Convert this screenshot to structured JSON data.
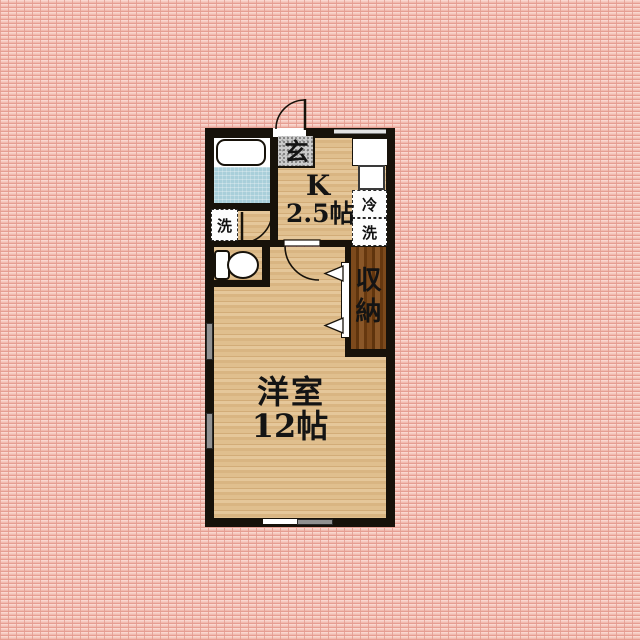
{
  "floorplan": {
    "entrance": {
      "label": "玄"
    },
    "kitchen": {
      "name": "K",
      "size": "2.5帖"
    },
    "main_room": {
      "name": "洋室",
      "size": "12帖"
    },
    "closet": {
      "chars": [
        "収",
        "納"
      ]
    },
    "equipment": {
      "washer_left": "洗",
      "fridge": "冷",
      "washer_right": "洗"
    },
    "colors": {
      "wall": "#17120a",
      "wood_floor": "#dfbe8d",
      "closet_wood": "#6e3e13",
      "bath_floor_blue": "#a9cfda",
      "entrance_tile_gray": "#cccccc",
      "background_pink": "#f2bdb2",
      "window_gray": "#919191"
    }
  }
}
